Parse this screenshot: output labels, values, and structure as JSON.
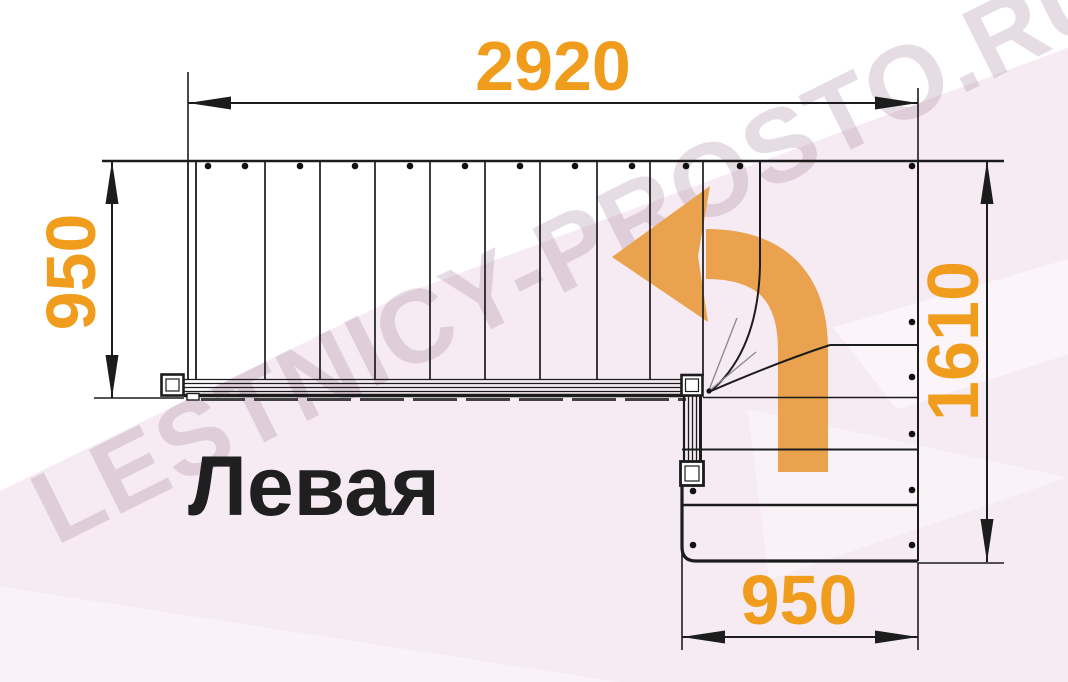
{
  "watermark": {
    "text": "LESTNICY-PROSTO.RU"
  },
  "plan": {
    "variant_label": "Левая"
  },
  "dimensions": {
    "top_width": "2920",
    "left_height": "950",
    "right_height": "1610",
    "bottom_width": "950"
  },
  "icons": {
    "direction_arrow": "turn-left-curved-arrow"
  },
  "colors": {
    "dimension_text": "#F09D1E",
    "arrow_orange": "#EAA24E",
    "line_black": "#1C1C1C",
    "label_black": "#1F1F1F",
    "background_pink": "#F6EBF3",
    "watermark_pink": "#D7B8CD"
  }
}
